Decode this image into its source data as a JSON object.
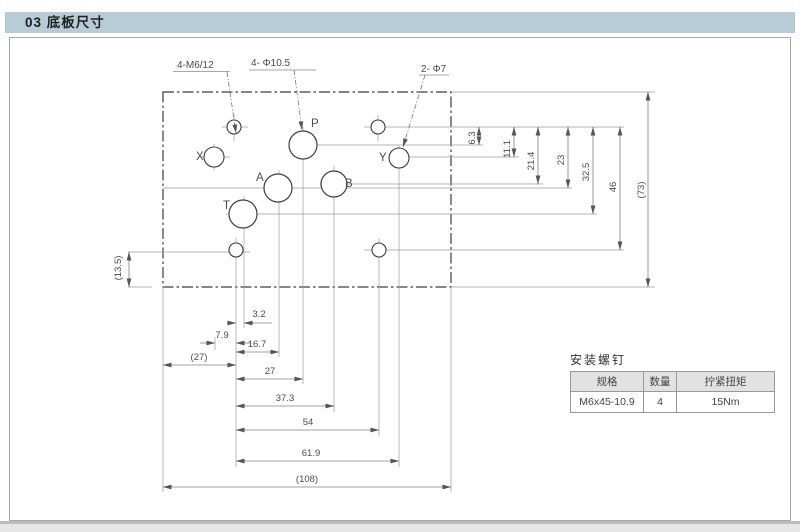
{
  "page": {
    "header": "03 底板尺寸"
  },
  "colors": {
    "header_bar": "#b8ccd8",
    "table_header_bg": "#e2e2e2"
  },
  "drawing": {
    "leaders": {
      "m6": "4-M6/12",
      "d105": "4- Φ10.5",
      "d7": "2- Φ7"
    },
    "ports": {
      "x": "X",
      "p": "P",
      "y": "Y",
      "a": "A",
      "b": "B",
      "t": "T"
    },
    "dims_h": {
      "d32": "3.2",
      "d79": "7.9",
      "d167": "16.7",
      "d27p": "(27)",
      "d27": "27",
      "d373": "37.3",
      "d54": "54",
      "d619": "61.9",
      "d108": "(108)"
    },
    "dims_v": {
      "d63": "6.3",
      "d111": "11.1",
      "d214": "21.4",
      "d23": "23",
      "d325": "32.5",
      "d46": "46",
      "d73": "(73)",
      "d135": "(13.5)"
    }
  },
  "screw_table": {
    "title": "安装螺钉",
    "headers": [
      "规格",
      "数量",
      "拧紧扭矩"
    ],
    "row": [
      "M6x45-10.9",
      "4",
      "15Nm"
    ]
  }
}
